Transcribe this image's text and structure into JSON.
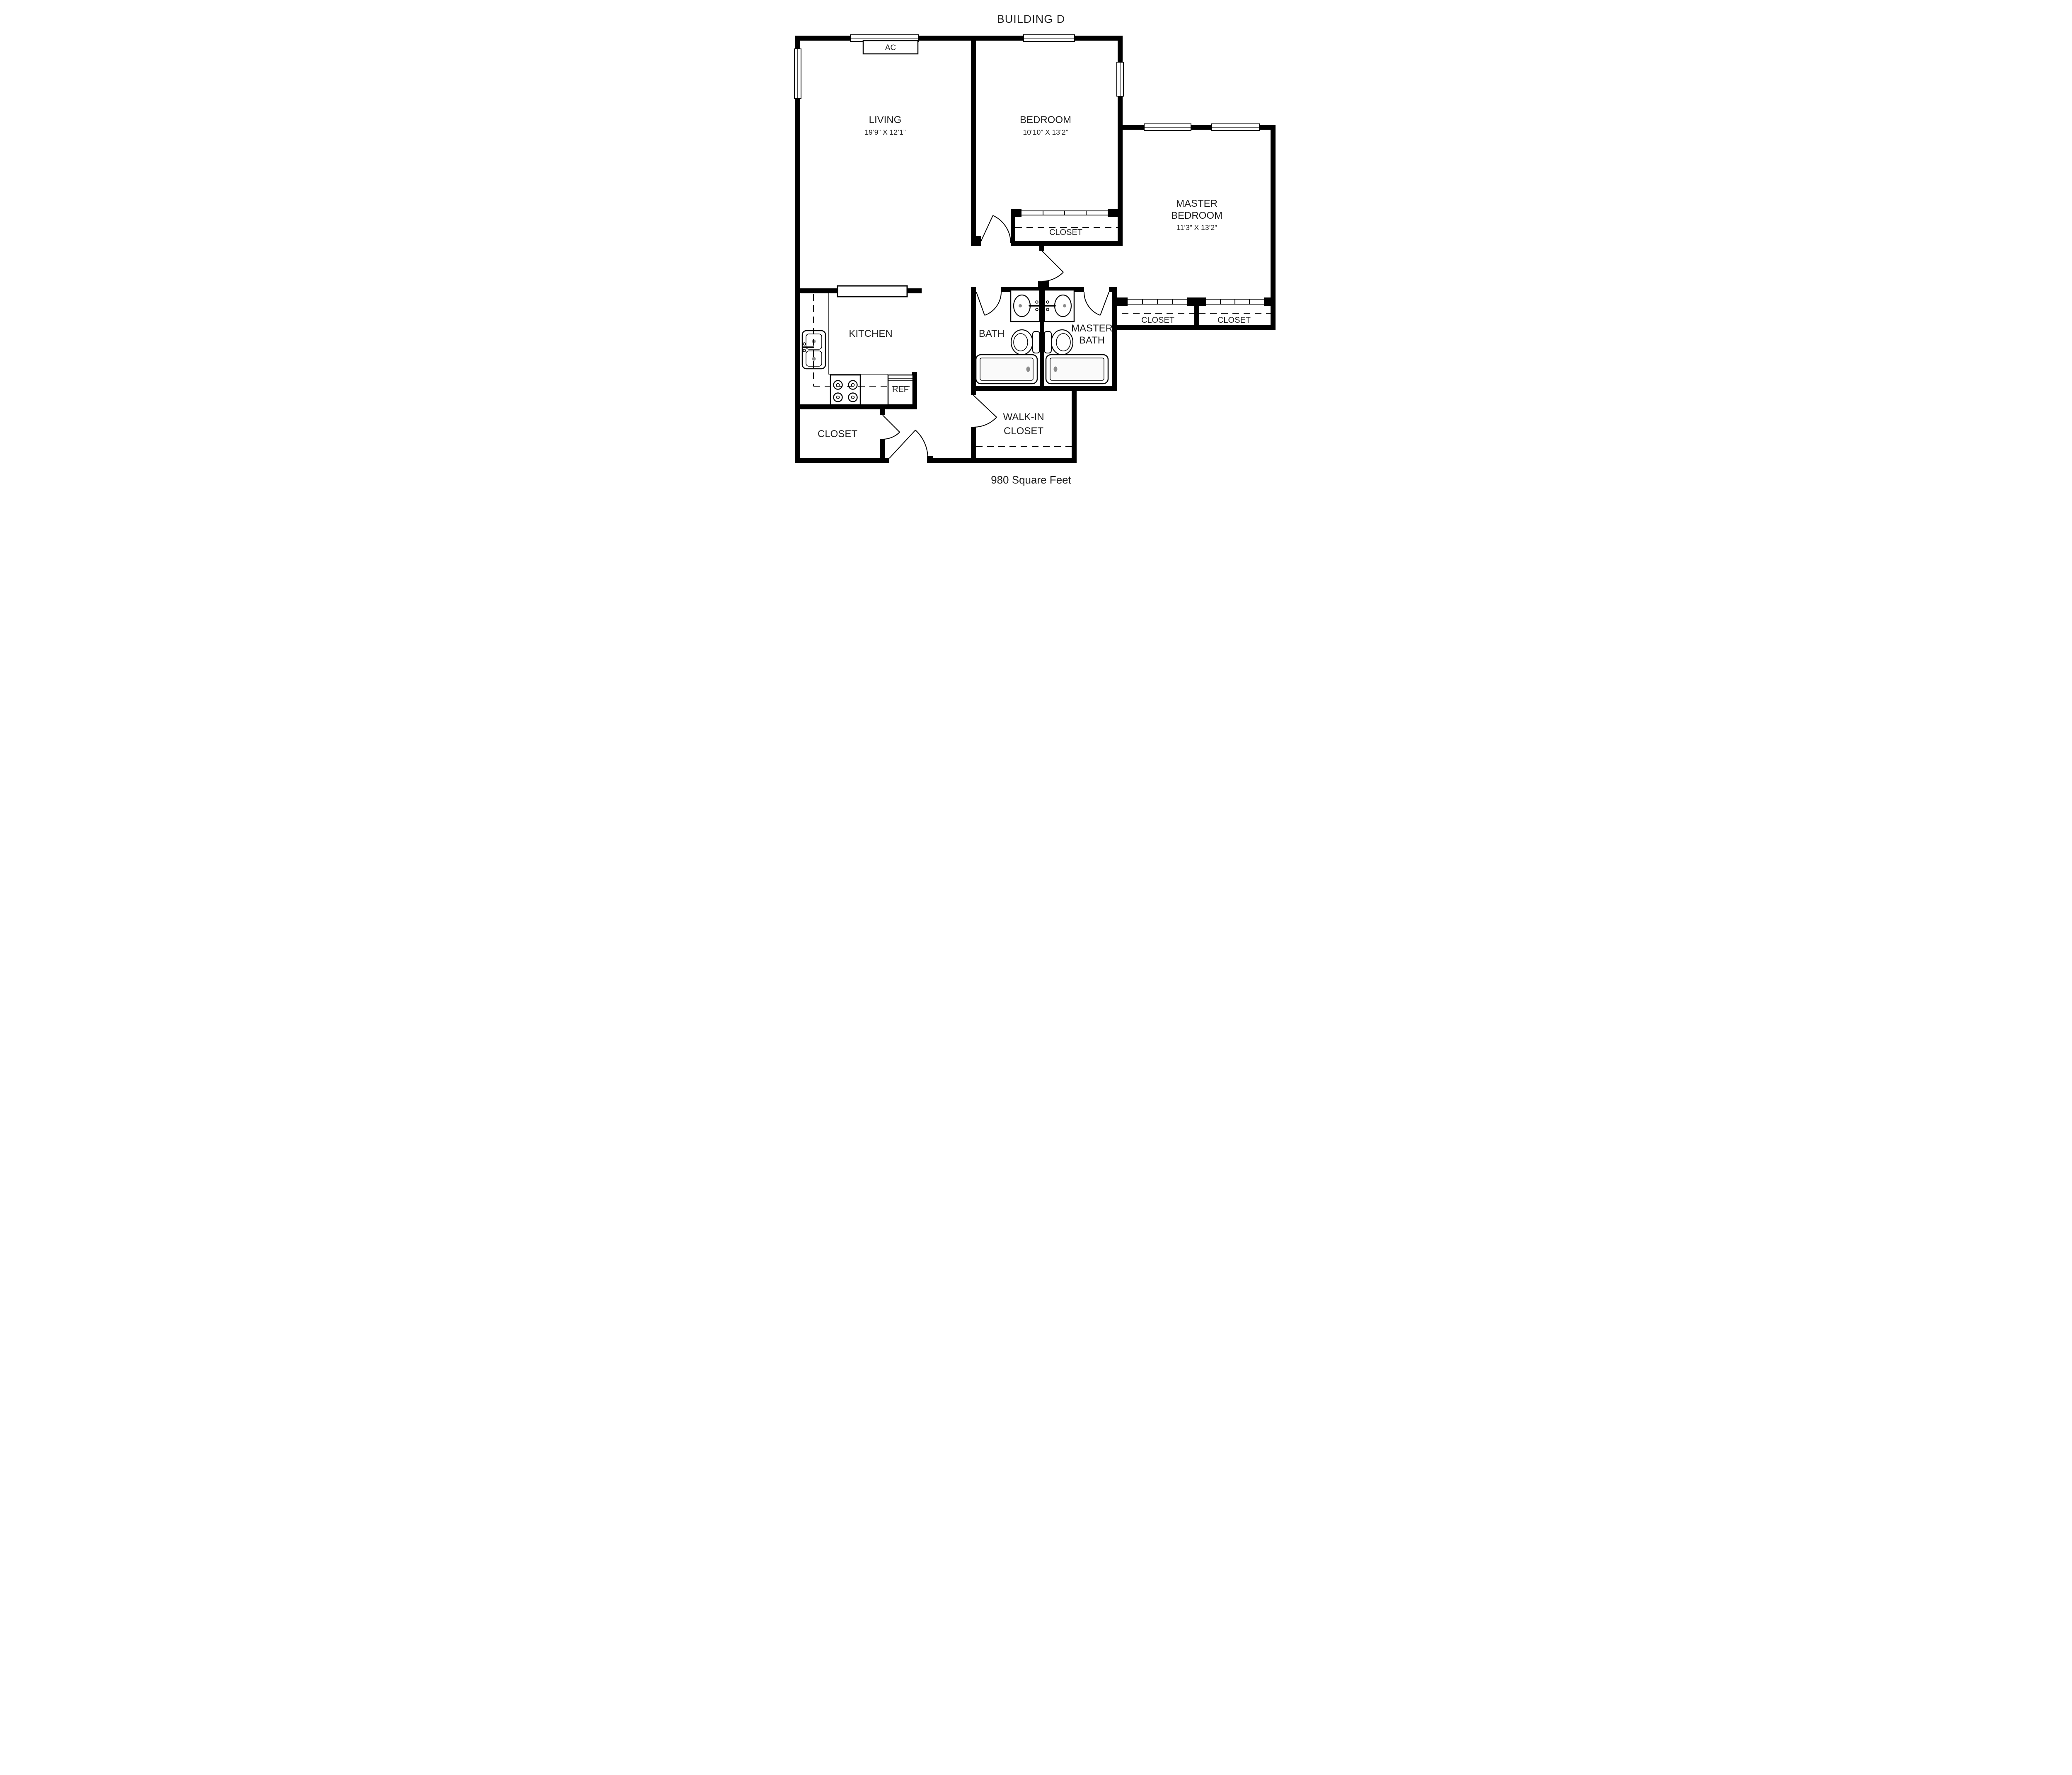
{
  "title": "BUILDING D",
  "footer": "980 Square Feet",
  "plan": {
    "ac_label": "AC",
    "ref_label": "REF",
    "colors": {
      "walls": "#000000",
      "background": "#ffffff",
      "drain_accent": "#8c8c8c"
    },
    "rooms": {
      "living": {
        "name": "LIVING",
        "dims": "19’9” X 12’1”"
      },
      "bedroom": {
        "name": "BEDROOM",
        "dims": "10’10” X 13’2”"
      },
      "master_bedroom": {
        "line1": "MASTER",
        "line2": "BEDROOM",
        "dims": "11’3” X 13’2”"
      },
      "kitchen": {
        "name": "KITCHEN"
      },
      "bath": {
        "name": "BATH"
      },
      "master_bath": {
        "line1": "MASTER",
        "line2": "BATH"
      },
      "walk_in_closet": {
        "line1": "WALK-IN",
        "line2": "CLOSET"
      },
      "bedroom_closet": {
        "name": "CLOSET"
      },
      "master_closet_left": {
        "name": "CLOSET"
      },
      "master_closet_right": {
        "name": "CLOSET"
      },
      "entry_closet": {
        "name": "CLOSET"
      }
    }
  }
}
